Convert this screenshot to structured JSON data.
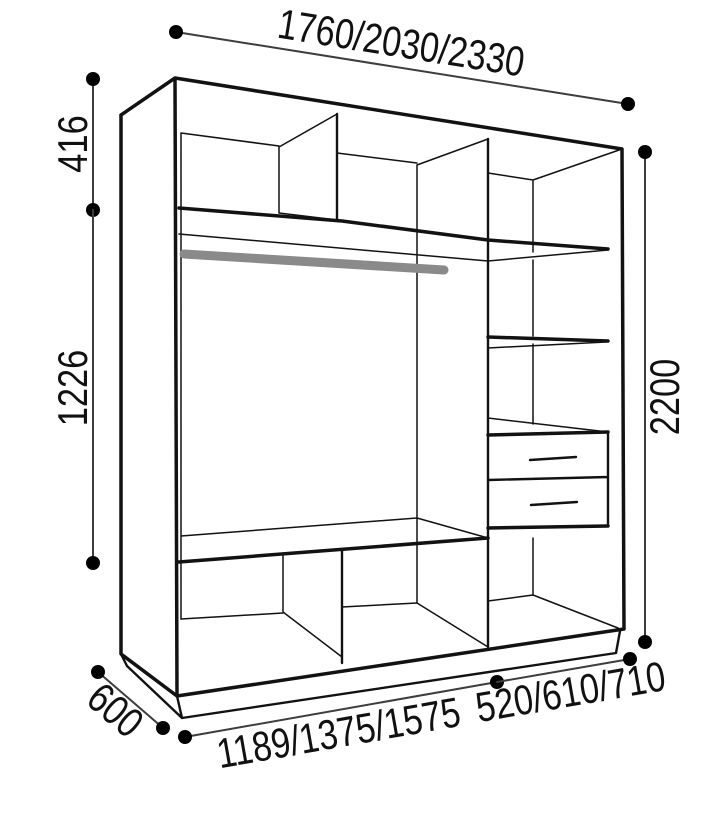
{
  "diagram": {
    "type": "furniture-dimension-drawing",
    "subject": "wardrobe-interior-wireframe",
    "labels": {
      "width_top": "1760/2030/2330",
      "upper_section_height": "416",
      "middle_section_height": "1226",
      "total_height": "2200",
      "depth": "600",
      "left_section_width": "1189/1375/1575",
      "right_section_width": "520/610/710"
    },
    "colors": {
      "background": "#ffffff",
      "outline": "#121212",
      "dimension_line": "#3d3d3d",
      "dimension_dot": "#000000",
      "hanging_rail": "#8a8a8a"
    }
  }
}
